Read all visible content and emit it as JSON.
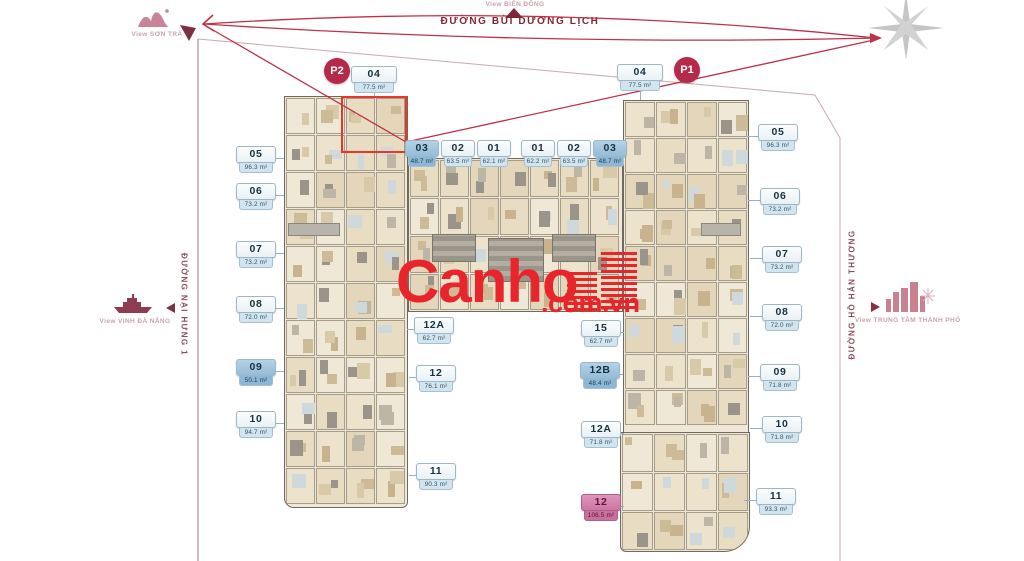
{
  "site": {
    "streets": {
      "top": "ĐƯỜNG BÙI DƯƠNG LỊCH",
      "left": "ĐƯỜNG NẠI HƯNG 1",
      "right": "ĐƯỜNG HỒ HÁN THƯƠNG"
    },
    "views": {
      "top_left": "View SƠN TRÀ",
      "top_center": "View BIỂN ĐÔNG",
      "left": "View VỊNH ĐÀ NẴNG",
      "right": "View TRUNG TÂM THÀNH PHỐ"
    }
  },
  "markers": {
    "p1": "P1",
    "p2": "P2"
  },
  "watermark": {
    "brand": "Canho",
    "suffix": ".com.vn"
  },
  "unit_groups": [
    {
      "name": "top-left-04",
      "units": [
        {
          "no": "04",
          "area": "77.5 m²",
          "variant": "plain"
        }
      ]
    },
    {
      "name": "inner-top-left",
      "units": [
        {
          "no": "03",
          "area": "48.7 m²",
          "variant": "blue"
        },
        {
          "no": "02",
          "area": "63.5 m²",
          "variant": "plain"
        },
        {
          "no": "01",
          "area": "62.1 m²",
          "variant": "plain"
        }
      ]
    },
    {
      "name": "inner-top-right",
      "units": [
        {
          "no": "01",
          "area": "62.2 m²",
          "variant": "plain"
        },
        {
          "no": "02",
          "area": "63.5 m²",
          "variant": "plain"
        },
        {
          "no": "03",
          "area": "48.7 m²",
          "variant": "blue"
        }
      ]
    },
    {
      "name": "top-right-04",
      "units": [
        {
          "no": "04",
          "area": "77.5 m²",
          "variant": "plain"
        }
      ]
    },
    {
      "name": "left-outer",
      "units": [
        {
          "no": "05",
          "area": "96.3 m²",
          "variant": "plain"
        },
        {
          "no": "06",
          "area": "73.2 m²",
          "variant": "plain"
        },
        {
          "no": "07",
          "area": "73.2 m²",
          "variant": "plain"
        },
        {
          "no": "08",
          "area": "72.0 m²",
          "variant": "plain"
        },
        {
          "no": "09",
          "area": "50.1 m²",
          "variant": "blue"
        },
        {
          "no": "10",
          "area": "94.7 m²",
          "variant": "plain"
        }
      ]
    },
    {
      "name": "left-inner",
      "units": [
        {
          "no": "12A",
          "area": "62.7 m²",
          "variant": "plain"
        },
        {
          "no": "12",
          "area": "76.1 m²",
          "variant": "plain"
        },
        {
          "no": "11",
          "area": "90.3 m²",
          "variant": "plain"
        }
      ]
    },
    {
      "name": "right-inner",
      "units": [
        {
          "no": "15",
          "area": "62.7 m²",
          "variant": "plain"
        },
        {
          "no": "12B",
          "area": "48.4 m²",
          "variant": "blue"
        },
        {
          "no": "12A",
          "area": "71.8 m²",
          "variant": "plain"
        },
        {
          "no": "12",
          "area": "106.5 m²",
          "variant": "pink"
        }
      ]
    },
    {
      "name": "right-outer",
      "units": [
        {
          "no": "05",
          "area": "96.3 m²",
          "variant": "plain"
        },
        {
          "no": "06",
          "area": "73.2 m²",
          "variant": "plain"
        },
        {
          "no": "07",
          "area": "73.2 m²",
          "variant": "plain"
        },
        {
          "no": "08",
          "area": "72.0 m²",
          "variant": "plain"
        },
        {
          "no": "09",
          "area": "71.8 m²",
          "variant": "plain"
        },
        {
          "no": "10",
          "area": "71.8 m²",
          "variant": "plain"
        },
        {
          "no": "11",
          "area": "93.3 m²",
          "variant": "plain"
        }
      ]
    },
    {
      "name": "center-partially-hidden",
      "units": [
        {
          "no": "13",
          "area": "",
          "variant": "plain"
        },
        {
          "no": "16",
          "area": "",
          "variant": "plain"
        }
      ]
    }
  ],
  "colors": {
    "accent_red": "#c13045",
    "marker_red": "#b5294a",
    "watermark_red": "#e8252b",
    "street_maroon": "#7e2836",
    "view_pink": "#c9a2aa",
    "label_highlight_blue": "#95bcd8",
    "label_pink": "#cc76a4",
    "unit_outline_red": "#e8372a",
    "compass_gray": "#c9c9c9"
  }
}
